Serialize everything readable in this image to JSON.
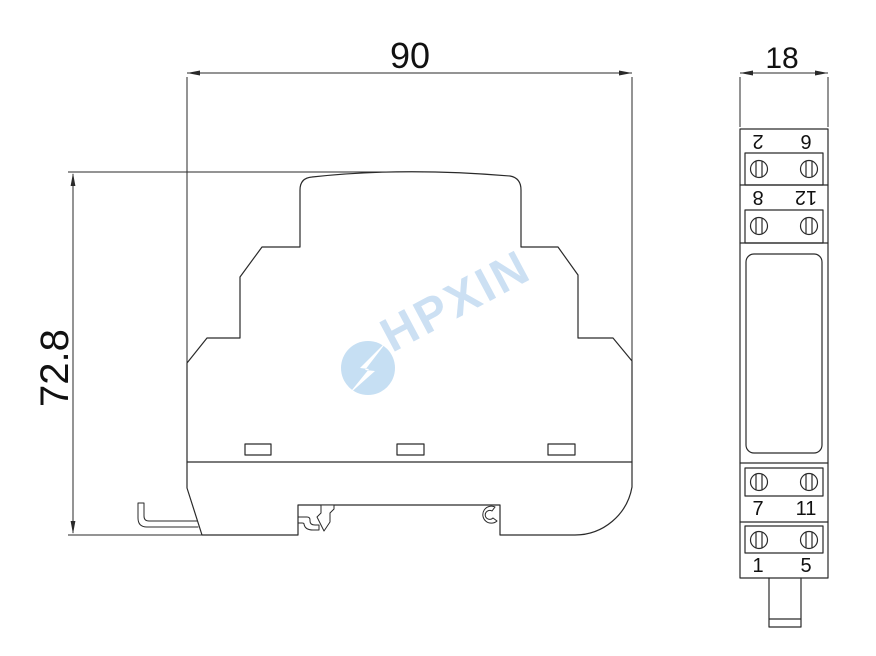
{
  "dimensions": {
    "side_width": "90",
    "side_height": "72.8",
    "front_width": "18"
  },
  "front_view": {
    "rows": [
      {
        "left": "2",
        "right": "6"
      },
      {
        "left": "8",
        "right": "12"
      },
      {
        "left": "7",
        "right": "11"
      },
      {
        "left": "1",
        "right": "5"
      }
    ]
  },
  "watermark": {
    "text": "HPXIN",
    "logo": "lightning-bolt-icon",
    "text_color": "#cce0f3",
    "logo_color": "#c6dff3"
  },
  "colors": {
    "line": "#2a2a2a",
    "background": "#ffffff",
    "dimension_text": "#111111"
  }
}
